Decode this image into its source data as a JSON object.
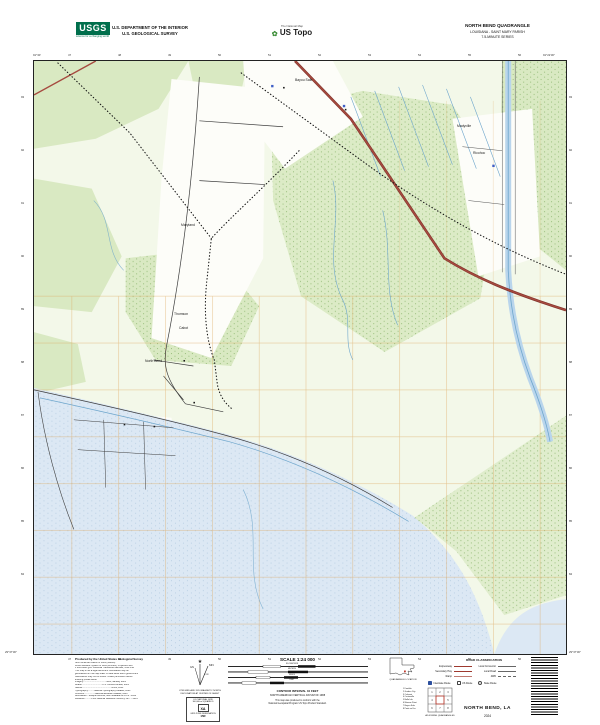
{
  "header": {
    "usgs_logo_text": "USGS",
    "usgs_tagline": "science for a changing world",
    "dept_line1": "U.S. DEPARTMENT OF THE INTERIOR",
    "dept_line2": "U.S. GEOLOGICAL SURVEY",
    "ustopo_tagline": "The National Map",
    "ustopo_brand": "US Topo",
    "quad_title": "NORTH BEND QUADRANGLE",
    "quad_subtitle": "LOUISIANA - SAINT MARY PARISH",
    "quad_series": "7.5-MINUTE SERIES"
  },
  "map": {
    "corner_labels": {
      "top_left": "91°30'",
      "top_right": "91°22'30\"",
      "bottom_left": "29°37'30\"",
      "bottom_right": "29°37'30\""
    },
    "ticks": {
      "top": [
        "47",
        "48",
        "49",
        "50",
        "51",
        "52",
        "53",
        "54",
        "55",
        "56"
      ],
      "bottom": [
        "47",
        "48",
        "49",
        "50",
        "51",
        "52",
        "53",
        "54",
        "55",
        "56"
      ],
      "left": [
        "93",
        "92",
        "91",
        "90",
        "89",
        "88",
        "87",
        "86",
        "85",
        "84"
      ],
      "right": [
        "93",
        "92",
        "91",
        "90",
        "89",
        "88",
        "87",
        "86",
        "85",
        "84"
      ]
    },
    "labels": [
      {
        "text": "Bayou Sale",
        "x": 262,
        "y": 18
      },
      {
        "text": "Madyville",
        "x": 424,
        "y": 64
      },
      {
        "text": "Ricohoc",
        "x": 440,
        "y": 91
      },
      {
        "text": "Maryland",
        "x": 148,
        "y": 163
      },
      {
        "text": "Thomson",
        "x": 141,
        "y": 252
      },
      {
        "text": "Cabot",
        "x": 146,
        "y": 266
      },
      {
        "text": "North Bend",
        "x": 112,
        "y": 299
      }
    ],
    "colors": {
      "highway": "#a64a3f",
      "water": "#dce8f4",
      "woodland": "#d9e9c2",
      "section_grid": "#dda85e",
      "canal": "#6ea6cc"
    }
  },
  "footer": {
    "fineprint": {
      "produced": "Produced by the United States Geological Survey",
      "lines": [
        "North American Datum of 1983 (NAD83)",
        "World Geodetic System of 1984 (WGS84). Projection and",
        "1 000-meter grid: Universal Transverse Mercator, zone 15R",
        "This map is not a legal document. Boundaries may be",
        "generalized for this map scale. Private lands within government",
        "reservations may not be shown. Obtain permission before",
        "entering private lands.",
        "Imagery.....................................NAIP, January 2023",
        "Roads.................................U.S. Census Bureau, 2023",
        "Names...............................................GNIS, 2023",
        "Hydrography..........National Hydrography Dataset, 2023",
        "Contours.................National Elevation Dataset, 2023",
        "Boundaries....Multiple sources; see metadata file 1972 - 2023",
        "Wetlands...........FWS National Wetlands Inventory 1977 - 2014"
      ]
    },
    "declination": {
      "gn": "GN",
      "mn": "MN",
      "angle": "0°35'",
      "caption1": "UTM GRID AND 2024 MAGNETIC NORTH",
      "caption2": "DECLINATION AT CENTER OF SHEET"
    },
    "usng": {
      "title": "U.S. NATIONAL GRID",
      "square_label": "100,000-m SQUARE ID",
      "square_id": "XA",
      "zone_label": "GRID ZONE DESIGNATION",
      "zone": "15R"
    },
    "scale": {
      "label": "SCALE 1:24 000",
      "units": [
        "KILOMETERS",
        "METERS",
        "MILES",
        "FEET"
      ],
      "contour1": "CONTOUR INTERVAL 10 FEET",
      "contour2": "NORTH AMERICAN VERTICAL DATUM OF 1988",
      "conform1": "This map was produced to conform with the",
      "conform2": "National Geospatial Program US Topo Product Standard."
    },
    "location": {
      "caption": "QUADRANGLE LOCATION"
    },
    "adjoining": {
      "caption": "ADJOINING QUADRANGLES",
      "list": [
        "1 Franklin",
        "2 Garden City",
        "3 Calumet",
        "4 Centerville",
        "5 Belle Isle",
        "6 Marone Point",
        "7 Bayou Sale",
        "8 Point au Fer"
      ]
    },
    "road_class": {
      "title": "ROAD CLASSIFICATION",
      "rows": [
        {
          "l": "Expressway",
          "ls": "expwy",
          "r": "Local Connector",
          "rs": "conn"
        },
        {
          "l": "Secondary Hwy",
          "ls": "sec",
          "r": "Local Road",
          "rs": "loc"
        },
        {
          "l": "Ramp",
          "ls": "ramp",
          "r": "4WD",
          "rs": "fourwd"
        }
      ],
      "shields": [
        {
          "type": "interstate",
          "label": "Interstate Route"
        },
        {
          "type": "us",
          "label": "US Route"
        },
        {
          "type": "state",
          "label": "State Route"
        }
      ]
    },
    "title": "NORTH BEND, LA",
    "year": "2024"
  }
}
